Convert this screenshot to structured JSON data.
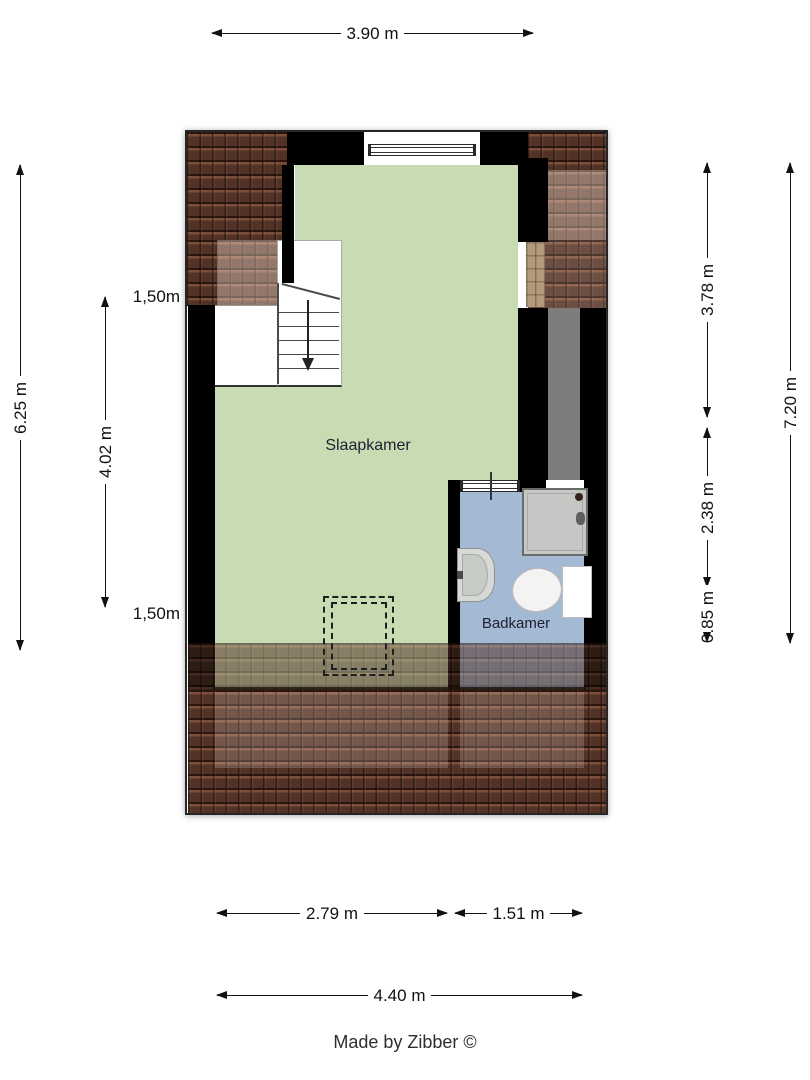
{
  "plan": {
    "floor_type": "attic-floorplan",
    "rooms": [
      {
        "name": "Slaapkamer",
        "floor_color": "#c8dcb4"
      },
      {
        "name": "Badkamer",
        "floor_color": "#a4b9d3"
      }
    ],
    "height_markers": {
      "top": "1,50m",
      "bottom": "1,50m"
    },
    "stairs": {
      "direction_icon": "down-arrow"
    },
    "fixtures": [
      "shower",
      "sink",
      "toilet",
      "top-window",
      "bathroom-door",
      "skylight-dashed-outline"
    ],
    "colors": {
      "wall": "#000000",
      "roof_tiles": "#503226",
      "duct_gray": "#7d7d7d",
      "tan_wall_strip": "#b49a7c"
    }
  },
  "dimensions": {
    "top": {
      "width_total": "3.90 m"
    },
    "left": {
      "outer": "6.25 m",
      "inner": "4.02 m"
    },
    "right": {
      "upper": "3.78 m",
      "lower": "2.38 m",
      "eave": "0.85 m",
      "total": "7.20 m"
    },
    "bottom": {
      "left_part": "2.79 m",
      "right_part": "1.51 m",
      "total": "4.40 m"
    }
  },
  "credit": "Made by Zibber ©"
}
